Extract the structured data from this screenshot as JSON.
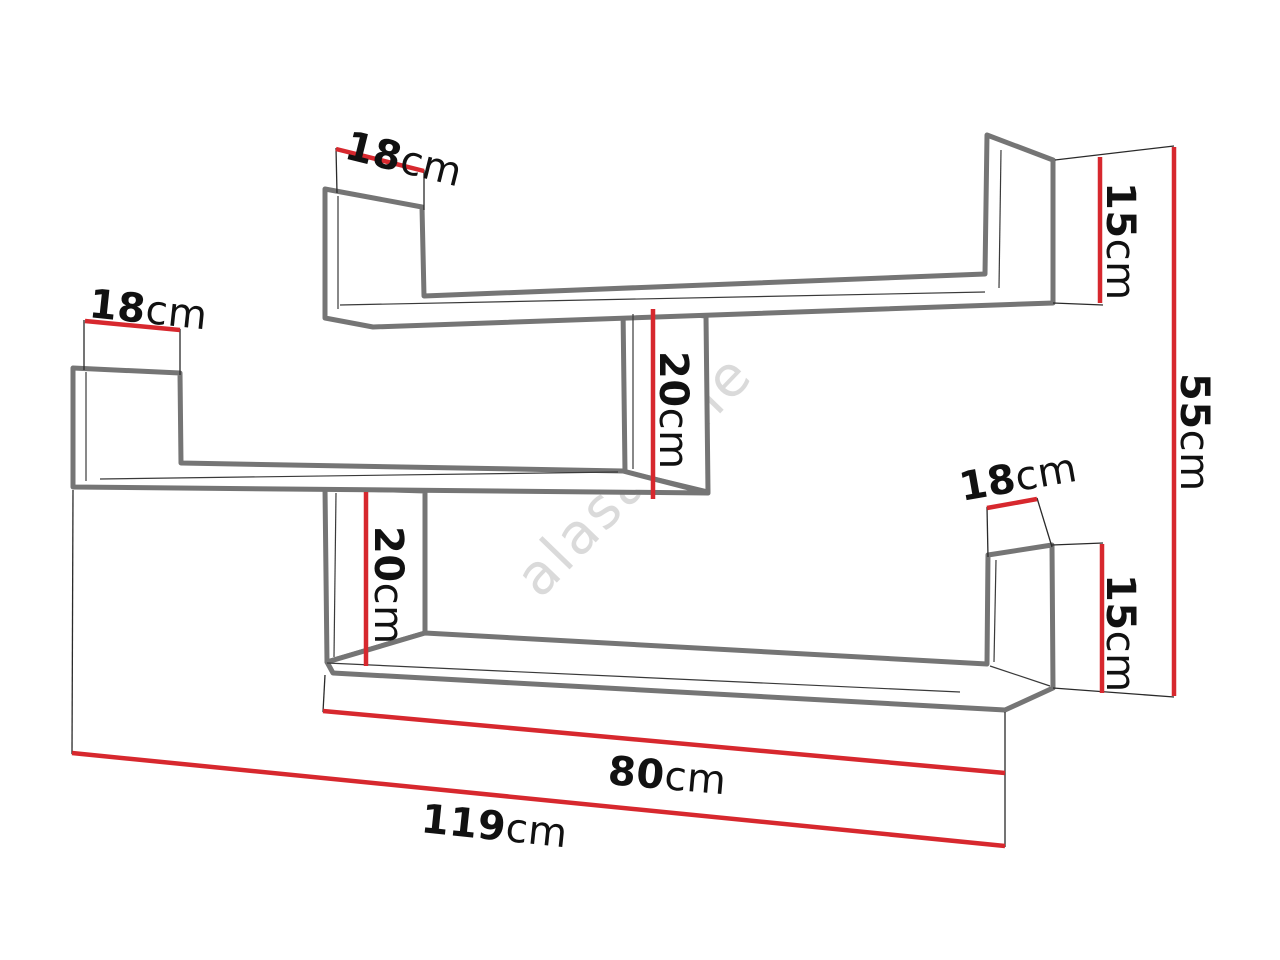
{
  "diagram": {
    "title": "wall-shelf-dimension-diagram",
    "watermark": "alasans.ie",
    "colors": {
      "dimension_red": "#d7282e",
      "outline_gray": "#757575",
      "text_black": "#111111",
      "watermark_gray": "#c3c3c3"
    },
    "labels": {
      "shelf_depth_top": {
        "value": "18",
        "unit": "cm"
      },
      "shelf_depth_left": {
        "value": "18",
        "unit": "cm"
      },
      "shelf_depth_bottom_right": {
        "value": "18",
        "unit": "cm"
      },
      "panel_height_top_right": {
        "value": "15",
        "unit": "cm"
      },
      "panel_height_bottom_right": {
        "value": "15",
        "unit": "cm"
      },
      "connector_height_middle": {
        "value": "20",
        "unit": "cm"
      },
      "connector_height_left": {
        "value": "20",
        "unit": "cm"
      },
      "total_height": {
        "value": "55",
        "unit": "cm"
      },
      "bottom_shelf_width": {
        "value": "80",
        "unit": "cm"
      },
      "total_width": {
        "value": "119",
        "unit": "cm"
      }
    }
  }
}
